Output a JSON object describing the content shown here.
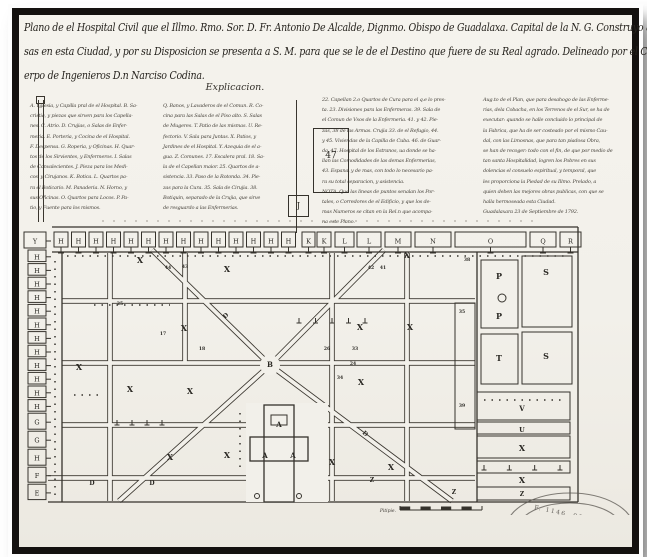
{
  "photo": {
    "title_lines": [
      "Plano de el Hospital Civil que el Illmo. Rmo. Sor. D. Fr. Antonio De Alcalde, Dignmo. Obispo de Guadalaxa. Capital de la N. G. Construyo a sus expen-",
      "sas en esta Ciudad, y por su Disposicion se presenta a S. M. para que se le de el Destino que fuere de su Real agrado. Delineado por el Capitan de el Real Cu-",
      "erpo de Ingenieros D.n Narciso Codina."
    ],
    "legend": {
      "heading": "Explicacion.",
      "box47_label": "47",
      "boxJ_label": "J",
      "col1_lines": [
        "A. Yglesia, y Capilla pral de el Hospital. B. Sa-",
        "cristia, y piezas que sirven para los Capella-",
        "nes. C. Atrio. D. Crujias, o Salas de Enfer-",
        "meria. E. Porteria, y Cocina de el Hospital.",
        "F. Despensa. G. Roperia, y Oficinas. H. Quar-",
        "tos de los Sirvientes, y Enfermeros. I. Salas",
        "de Convalecientes. J. Pieza para los Medi-",
        "cos, y Cirujanos. K. Botica. L. Quartos pa-",
        "ra el Boticario. M. Panaderia. N. Horno, y",
        "sus Oficinas. O. Quartos para Locos. P. Pa-",
        "tio, y Fuente para los mismos."
      ],
      "col2_lines": [
        "Q. Banos, y Lavaderos de el Comun. R. Co-",
        "cina para las Salas de el Piso alto. S. Salas",
        "de Mugeres. T. Patio de las mismas. U. Re-",
        "fectorio. V. Sala para Juntas. X. Patios, y",
        "Jardines de el Hospital. Y. Azequia de el a-",
        "gua. Z. Comunes. 17. Escalera pral. 18. Sa-",
        "la de el Capellan maior. 25. Quartos de a-",
        "sistencia. 33. Paso de la Rotonda. 34. Pie-",
        "zas para la Cura. 35. Sala de Cirujia. 38.",
        "Botiquin, separado de la Crujia, que sirve",
        "de resguardo a las Enfermerias."
      ],
      "col3_lines": [
        "22. Capellan 2.o Quartos de Cura para el q.e lo pres-",
        "ta. 23. Divisiones para las Enfermeras. 39. Sala de",
        "el Comun de Vsos de la Enfermeria. 41. y 42. Pie-",
        "zas, 38 de las Armas. Crujia 33. de el Refugio, 44.",
        "y 45. Viviendas de la Capilla de Cuba. 46. de Guar-",
        "da, 47. Hospital de los Estranos, ua donde se ha-",
        "llan las Comodidades de las demas Enfermerias,",
        "43. Espana, y de mas, con todo lo necesario pa-",
        "ra su total separacion, y asistencia.",
        "NOTA. Que las lineas de puntos senalan los Por-",
        "tales, o Corredores de el Edificio, y que los de-",
        "mas Numeros se citan en la Rel.n que acompa-",
        "na este Plano."
      ],
      "col4_lines": [
        "Aug.to de el Plan, que para desahogo de las Enferme-",
        "rias, dela Cobacha, en los Terrenos de el Sur, se ha de",
        "executar: quando se halle concluido lo principal de",
        "la Fabrica, que ha de ser costeado por el mismo Cau-",
        "dal, con las Limosnas, que para tan piadosa Obra,",
        "se han de recoger: todo con el fin, de que por medio de",
        "tan santa Hospitalidad, logren los Pobres en sus",
        "dolencias el consuelo espiritual, y temporal, que",
        "les proporciona la Piedad de su Illmo. Prelado, a",
        "quien deben las mejores obras publicas, con que se",
        "halla hermoseada esta Ciudad.",
        "Guadalaxara 23 de Septiembre de 1792."
      ]
    },
    "plan": {
      "scale_label": "Pitipie.",
      "stamp_text": "F. 1146. 90",
      "top_row": [
        {
          "t": "H",
          "x": 32,
          "w": 14
        },
        {
          "t": "H",
          "x": 49.5,
          "w": 14
        },
        {
          "t": "H",
          "x": 67,
          "w": 14
        },
        {
          "t": "H",
          "x": 84.5,
          "w": 14
        },
        {
          "t": "H",
          "x": 102,
          "w": 14
        },
        {
          "t": "H",
          "x": 119.5,
          "w": 14
        },
        {
          "t": "H",
          "x": 137,
          "w": 14
        },
        {
          "t": "H",
          "x": 154.5,
          "w": 14
        },
        {
          "t": "H",
          "x": 172,
          "w": 14
        },
        {
          "t": "H",
          "x": 189.5,
          "w": 14
        },
        {
          "t": "H",
          "x": 207,
          "w": 14
        },
        {
          "t": "H",
          "x": 224.5,
          "w": 14
        },
        {
          "t": "H",
          "x": 242,
          "w": 14
        },
        {
          "t": "H",
          "x": 259.5,
          "w": 14
        },
        {
          "t": "K",
          "x": 280,
          "w": 13
        },
        {
          "t": "K",
          "x": 295,
          "w": 14
        },
        {
          "t": "L",
          "x": 313,
          "w": 19
        },
        {
          "t": "L",
          "x": 335,
          "w": 24
        },
        {
          "t": "M",
          "x": 363,
          "w": 26
        },
        {
          "t": "N",
          "x": 393,
          "w": 36
        },
        {
          "t": "O",
          "x": 433,
          "w": 71
        },
        {
          "t": "Q",
          "x": 508,
          "w": 26
        },
        {
          "t": "R",
          "x": 538,
          "w": 21
        }
      ],
      "left_col": [
        "Y",
        "H",
        "H",
        "H",
        "H",
        "H",
        "H",
        "H",
        "H",
        "H",
        "H",
        "H",
        "H",
        "G",
        "G",
        "H",
        "F",
        "E"
      ],
      "labels": [
        {
          "t": "B",
          "x": 248,
          "y": 152,
          "s": 7
        },
        {
          "t": "X",
          "x": 118,
          "y": 48
        },
        {
          "t": "X",
          "x": 205,
          "y": 57
        },
        {
          "t": "X",
          "x": 385,
          "y": 43
        },
        {
          "t": "X",
          "x": 162,
          "y": 116
        },
        {
          "t": "X",
          "x": 338,
          "y": 115
        },
        {
          "t": "X",
          "x": 388,
          "y": 115
        },
        {
          "t": "X",
          "x": 57,
          "y": 155
        },
        {
          "t": "X",
          "x": 108,
          "y": 177
        },
        {
          "t": "X",
          "x": 168,
          "y": 179
        },
        {
          "t": "X",
          "x": 339,
          "y": 170
        },
        {
          "t": "X",
          "x": 148,
          "y": 245
        },
        {
          "t": "X",
          "x": 205,
          "y": 243
        },
        {
          "t": "X",
          "x": 310,
          "y": 250
        },
        {
          "t": "X",
          "x": 369,
          "y": 255
        },
        {
          "t": "P",
          "x": 477,
          "y": 64
        },
        {
          "t": "P",
          "x": 477,
          "y": 104
        },
        {
          "t": "S",
          "x": 524,
          "y": 60
        },
        {
          "t": "T",
          "x": 477,
          "y": 146
        },
        {
          "t": "S",
          "x": 524,
          "y": 144
        },
        {
          "t": "V",
          "x": 500,
          "y": 196,
          "s": 7
        },
        {
          "t": "U",
          "x": 500,
          "y": 217,
          "s": 6.5
        },
        {
          "t": "X",
          "x": 500,
          "y": 236
        },
        {
          "t": "X",
          "x": 500,
          "y": 268
        },
        {
          "t": "Z",
          "x": 500,
          "y": 281,
          "s": 6
        },
        {
          "t": "A",
          "x": 257,
          "y": 212,
          "s": 7
        },
        {
          "t": "A",
          "x": 243,
          "y": 243,
          "s": 7
        },
        {
          "t": "A",
          "x": 271,
          "y": 243,
          "s": 7
        },
        {
          "t": "D",
          "x": 70,
          "y": 270,
          "s": 6
        },
        {
          "t": "D",
          "x": 130,
          "y": 270,
          "s": 6
        },
        {
          "t": "D",
          "x": 342,
          "y": 220,
          "s": 6,
          "r": 40
        },
        {
          "t": "D",
          "x": 205,
          "y": 102,
          "s": 6,
          "r": -44
        },
        {
          "t": "Z",
          "x": 350,
          "y": 267,
          "s": 6
        },
        {
          "t": "Z",
          "x": 432,
          "y": 279,
          "s": 6
        },
        {
          "t": "44",
          "x": 146,
          "y": 54,
          "s": 4.5
        },
        {
          "t": "43",
          "x": 163,
          "y": 53,
          "s": 4.5
        },
        {
          "t": "42",
          "x": 349,
          "y": 54,
          "s": 4.5
        },
        {
          "t": "41",
          "x": 361,
          "y": 54,
          "s": 4.5
        },
        {
          "t": "38",
          "x": 445,
          "y": 46,
          "s": 4.5
        },
        {
          "t": "35",
          "x": 440,
          "y": 98,
          "s": 4.5
        },
        {
          "t": "39",
          "x": 440,
          "y": 192,
          "s": 4.5
        },
        {
          "t": "17",
          "x": 141,
          "y": 120,
          "s": 4.5
        },
        {
          "t": "18",
          "x": 180,
          "y": 135,
          "s": 4.5
        },
        {
          "t": "24",
          "x": 331,
          "y": 150,
          "s": 4.5
        },
        {
          "t": "33",
          "x": 333,
          "y": 135,
          "s": 4.5
        },
        {
          "t": "34",
          "x": 318,
          "y": 164,
          "s": 4.5
        },
        {
          "t": "25",
          "x": 98,
          "y": 90,
          "s": 4.5
        },
        {
          "t": "26",
          "x": 305,
          "y": 135,
          "s": 4.5
        }
      ]
    },
    "colors": {
      "paper": "#f2f0ea",
      "ink": "#35322c",
      "frame": "#14110f"
    }
  }
}
